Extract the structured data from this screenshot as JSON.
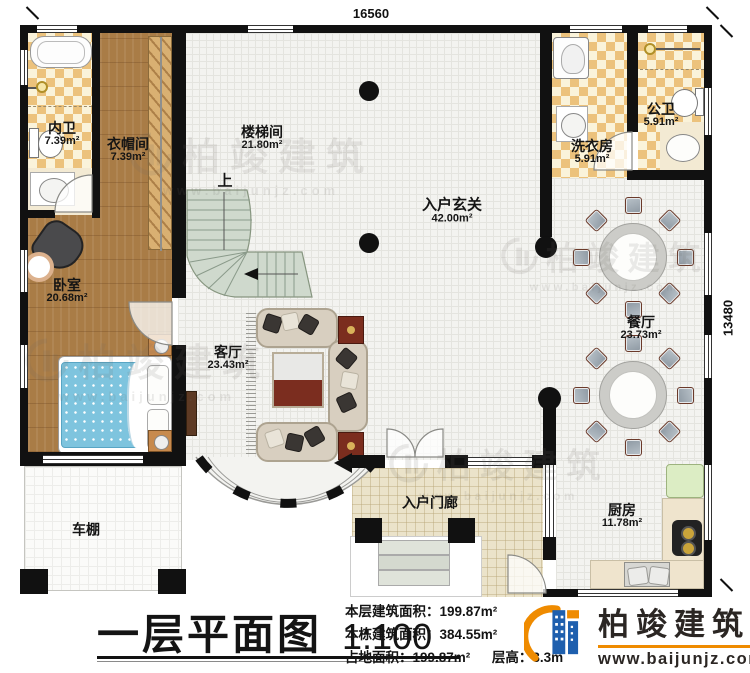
{
  "plan": {
    "dimension_top": "16560",
    "dimension_right": "13480",
    "stair_up_label": "上",
    "rooms": [
      {
        "name": "内卫",
        "area": "7.39m²"
      },
      {
        "name": "衣帽间",
        "area": "7.39m²"
      },
      {
        "name": "楼梯间",
        "area": "21.80m²"
      },
      {
        "name": "入户玄关",
        "area": "42.00m²"
      },
      {
        "name": "洗衣房",
        "area": "5.91m²"
      },
      {
        "name": "公卫",
        "area": "5.91m²"
      },
      {
        "name": "卧室",
        "area": "20.68m²"
      },
      {
        "name": "餐厅",
        "area": "23.73m²"
      },
      {
        "name": "客厅",
        "area": "23.43m²"
      },
      {
        "name": "车棚",
        "area": ""
      },
      {
        "name": "入户门廊",
        "area": ""
      },
      {
        "name": "厨房",
        "area": "11.78m²"
      }
    ]
  },
  "titleblock": {
    "title": "一层平面图",
    "scale": "1:100",
    "stats": [
      {
        "label": "本层建筑面积：",
        "value": "199.87m²"
      },
      {
        "label": "本栋建筑面积：",
        "value": "384.55m²"
      },
      {
        "label": "占地面积：",
        "value": "199.87m²"
      },
      {
        "label": "层高：",
        "value": "3.3m"
      }
    ]
  },
  "brand": {
    "name": "柏竣建筑",
    "url": "www.baijunjz.com"
  },
  "watermark": {
    "name": "柏竣建筑",
    "url": "www.baijunjz.com"
  },
  "colors": {
    "wall": "#111111",
    "wood": "#a97c46",
    "tile_accent": "#ecc27c",
    "stair": "#cfd9cd",
    "brand_blue": "#1e5fae",
    "brand_orange": "#ef8b00"
  }
}
